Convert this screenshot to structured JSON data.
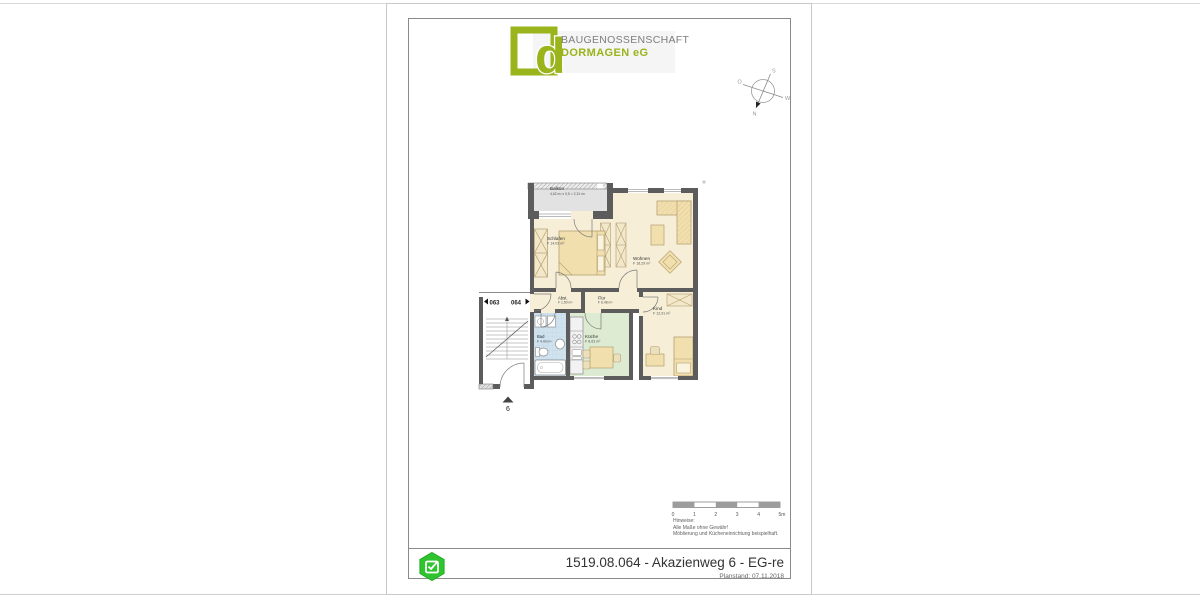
{
  "logo": {
    "letter": "d",
    "name": "BAUGENOSSENSCHAFT",
    "subname": "DORMAGEN eG"
  },
  "compass": {
    "n": "N",
    "s": "S",
    "o": "O",
    "w": "W"
  },
  "plan": {
    "rooms": [
      {
        "name": "Balkon",
        "area": "4,62 m² x 0,5 = 2,31 m²"
      },
      {
        "name": "Schlafen",
        "area": "F 14,03 m²"
      },
      {
        "name": "Wohnen",
        "area": "F 18,29 m²"
      },
      {
        "name": "Abst.",
        "area": "F 1,50 m²"
      },
      {
        "name": "Flur",
        "area": "F 6,48 m²"
      },
      {
        "name": "Kind",
        "area": "F 12,91 m²"
      },
      {
        "name": "Bad",
        "area": "F 4,43 m²"
      },
      {
        "name": "Küche",
        "area": "F 8,63 m²"
      }
    ],
    "unit_left": "063",
    "unit_right": "064",
    "entrance_number": "6"
  },
  "scalebar": {
    "ticks": [
      "0",
      "1",
      "2",
      "3",
      "4",
      "5m"
    ]
  },
  "notes": {
    "heading": "Hinweise:",
    "lines": [
      "Alle Maße ohne Gewähr!",
      "Möblierung und Kücheneinrichtung beispielhaft."
    ]
  },
  "titleblock": {
    "title": "1519.08.064 - Akazienweg 6 - EG-re",
    "planstand": "Planstand: 07.11.2018"
  },
  "colors": {
    "logo_green": "#9ab41c",
    "badge_green": "#2fc42f",
    "wall_gray": "#5c5c5c",
    "room_cream": "#f6eed7",
    "bath_blue": "#cfe2ee",
    "kitchen_green": "#dcebd2",
    "balcony_gray": "#e2e2e2",
    "furniture_tan": "#f2dfae"
  }
}
